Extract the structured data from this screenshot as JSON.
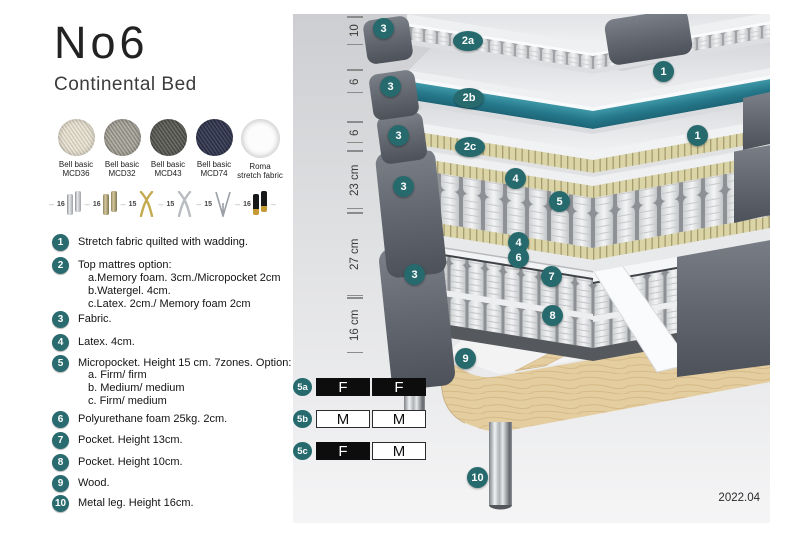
{
  "header": {
    "title": "No6",
    "subtitle": "Continental Bed"
  },
  "swatches": [
    {
      "name": "Bell basic",
      "code": "MCD36"
    },
    {
      "name": "Bell basic",
      "code": "MCD32"
    },
    {
      "name": "Bell basic",
      "code": "MCD43"
    },
    {
      "name": "Bell basic",
      "code": "MCD74"
    },
    {
      "name": "Roma",
      "code": "stretch fabric"
    }
  ],
  "legs": [
    {
      "height": "16"
    },
    {
      "height": "16"
    },
    {
      "height": "15"
    },
    {
      "height": "15"
    },
    {
      "height": "15"
    },
    {
      "height": "16"
    }
  ],
  "features": [
    {
      "num": "1",
      "text": "Stretch fabric quilted with wadding."
    },
    {
      "num": "2",
      "text": "Top mattres option:",
      "subitems": [
        "a.Memory foam. 3cm./Micropocket 2cm",
        "b.Watergel. 4cm.",
        "c.Latex. 2cm./ Memory foam 2cm"
      ]
    },
    {
      "num": "3",
      "text": "Fabric."
    },
    {
      "num": "4",
      "text": "Latex. 4cm."
    },
    {
      "num": "5",
      "text": "Micropocket. Height 15 cm. 7zones. Option:",
      "subitems": [
        "a. Firm/ firm",
        "b. Medium/ medium",
        "c. Firm/ medium"
      ]
    },
    {
      "num": "6",
      "text": "Polyurethane foam 25kg. 2cm."
    },
    {
      "num": "7",
      "text": "Pocket. Height 13cm."
    },
    {
      "num": "8",
      "text": "Pocket. Height 10cm."
    },
    {
      "num": "9",
      "text": "Wood."
    },
    {
      "num": "10",
      "text": "Metal leg. Height 16cm."
    }
  ],
  "diagram": {
    "dimensions": [
      {
        "label": "10"
      },
      {
        "label": "6"
      },
      {
        "label": "6"
      },
      {
        "label": "23 cm"
      },
      {
        "label": "27 cm"
      },
      {
        "label": "16 cm"
      }
    ],
    "callouts": [
      {
        "text": "3"
      },
      {
        "text": "2a"
      },
      {
        "text": "1"
      },
      {
        "text": "3"
      },
      {
        "text": "2b"
      },
      {
        "text": "3"
      },
      {
        "text": "2c"
      },
      {
        "text": "1"
      },
      {
        "text": "4"
      },
      {
        "text": "3"
      },
      {
        "text": "5"
      },
      {
        "text": "4"
      },
      {
        "text": "6"
      },
      {
        "text": "3"
      },
      {
        "text": "7"
      },
      {
        "text": "8"
      },
      {
        "text": "9"
      },
      {
        "text": "10"
      }
    ],
    "firmness": {
      "rows": [
        {
          "label": "5a",
          "cells": [
            {
              "text": "F",
              "variant": "dark"
            },
            {
              "text": "F",
              "variant": "dark"
            }
          ]
        },
        {
          "label": "5b",
          "cells": [
            {
              "text": "M",
              "variant": "light"
            },
            {
              "text": "M",
              "variant": "light"
            }
          ]
        },
        {
          "label": "5c",
          "cells": [
            {
              "text": "F",
              "variant": "dark"
            },
            {
              "text": "M",
              "variant": "light"
            }
          ]
        }
      ]
    },
    "version": "2022.04"
  },
  "colors": {
    "accent": "#266a6e",
    "teal_layer": "#26798b",
    "fabric_gray": "#63676f",
    "wood": "#e0c89b"
  }
}
